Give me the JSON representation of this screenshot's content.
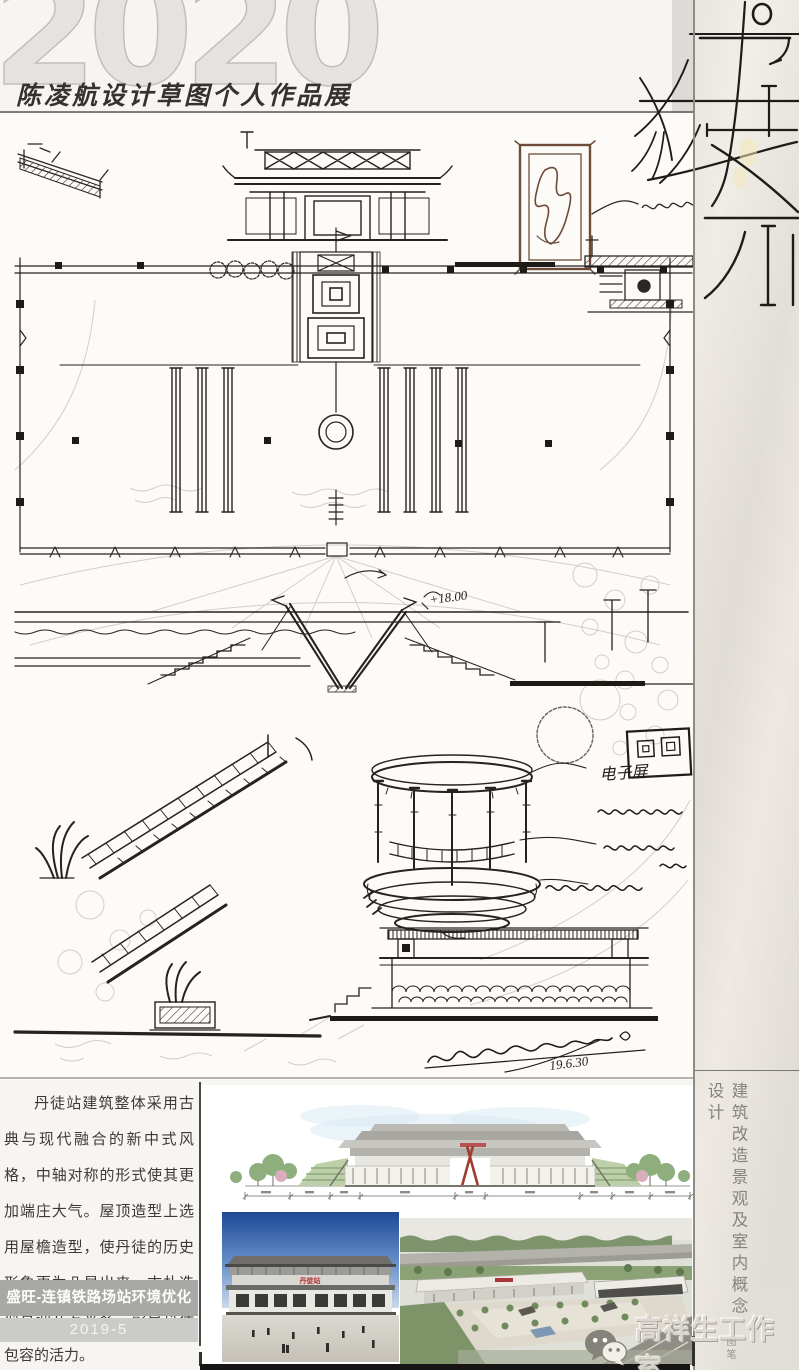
{
  "header": {
    "year": "2020",
    "exhibition_title": "陈凌航设计草图个人作品展"
  },
  "sketch_annotations": {
    "screen_note": "电子屏",
    "level_mark": "+18.00",
    "sketch_date": "19.6.30"
  },
  "description": {
    "body": "丹徒站建筑整体采用古典与现代融合的新中式风格，中轴对称的形式使其更加端庄大气。屋顶造型上选用屋檐造型，使丹徒的历史形象更为凸显出来。古朴造型喜迎八方来客，彰显丹徒包容的活力。"
  },
  "project": {
    "name_banner": "盛旺-连镇铁路场站环境优化",
    "date_banner": "2019-5"
  },
  "right_column": {
    "vertical_caption": "建筑改造景观及室内概念设计",
    "corner_note": "图笔"
  },
  "photos": {
    "station_sign": "丹徒站"
  },
  "branding": {
    "studio_name": "高祥生工作室",
    "logo": "wechat-icon"
  },
  "colors": {
    "accent_red": "#a03c2e",
    "banner_gray": "#a8a8a6",
    "banner_light_gray": "#cbcbc9",
    "ink": "#2a2822",
    "pencil": "#c6c1b7"
  }
}
